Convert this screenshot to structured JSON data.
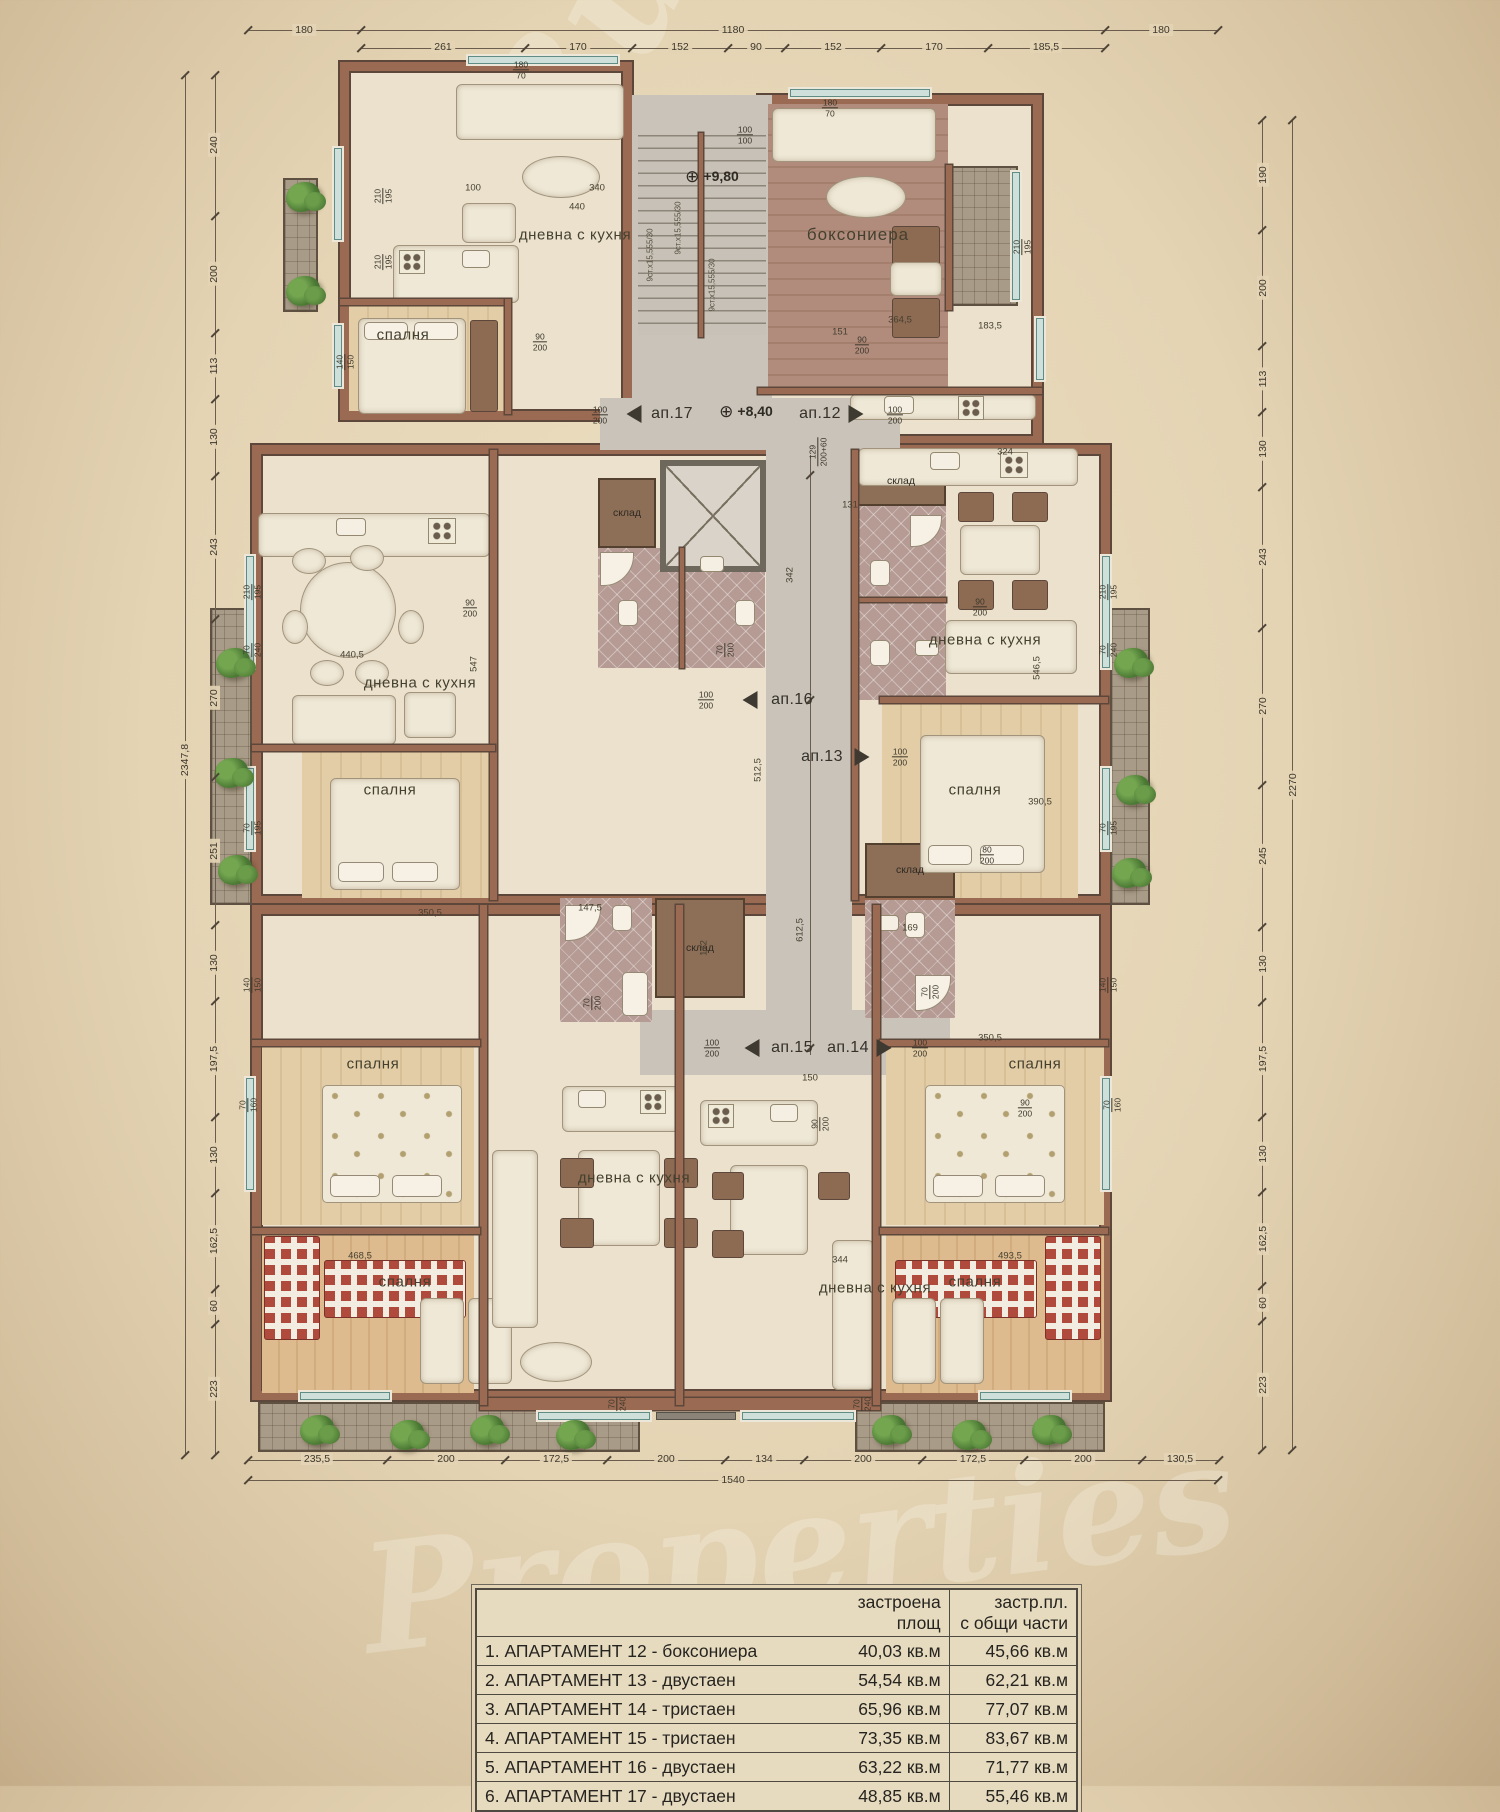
{
  "watermark": {
    "line1": "Bulgarian",
    "line2": "Properties"
  },
  "colors": {
    "wall": "#9b6a52",
    "wall_edge": "#5c473a",
    "floor": "#ebe1cc",
    "tile": "#b59b93",
    "corridor": "#c9c3b9",
    "window_glass": "#cfe0da",
    "paper": "#e4d4b4",
    "plant": "#4c7a35"
  },
  "plan": {
    "room_labels": [
      {
        "t": "дневна с кухня",
        "x": 575,
        "y": 235
      },
      {
        "t": "спалня",
        "x": 403,
        "y": 335
      },
      {
        "t": "боксониера",
        "x": 858,
        "y": 235,
        "big": 1
      },
      {
        "t": "дневна с кухня",
        "x": 420,
        "y": 683
      },
      {
        "t": "спалня",
        "x": 390,
        "y": 790
      },
      {
        "t": "дневна с кухня",
        "x": 985,
        "y": 640
      },
      {
        "t": "спалня",
        "x": 975,
        "y": 790
      },
      {
        "t": "спалня",
        "x": 373,
        "y": 1064
      },
      {
        "t": "дневна с кухня",
        "x": 634,
        "y": 1178
      },
      {
        "t": "спалня",
        "x": 405,
        "y": 1282
      },
      {
        "t": "дневна с кухня",
        "x": 875,
        "y": 1288
      },
      {
        "t": "спалня",
        "x": 1035,
        "y": 1064
      },
      {
        "t": "спалня",
        "x": 975,
        "y": 1282
      }
    ],
    "closet_labels": [
      {
        "t": "склад",
        "x": 627,
        "y": 513
      },
      {
        "t": "склад",
        "x": 901,
        "y": 481
      },
      {
        "t": "склад",
        "x": 700,
        "y": 948
      },
      {
        "t": "склад",
        "x": 910,
        "y": 870
      }
    ],
    "apt_markers": [
      {
        "t": "ап.17",
        "x": 672,
        "y": 414
      },
      {
        "t": "ап.12",
        "x": 820,
        "y": 414
      },
      {
        "t": "ап.16",
        "x": 792,
        "y": 700
      },
      {
        "t": "ап.13",
        "x": 822,
        "y": 757
      },
      {
        "t": "ап.15",
        "x": 792,
        "y": 1048
      },
      {
        "t": "ап.14",
        "x": 848,
        "y": 1048
      }
    ],
    "arrows": [
      {
        "d": "l",
        "x": 634,
        "y": 414
      },
      {
        "d": "r",
        "x": 856,
        "y": 414
      },
      {
        "d": "l",
        "x": 750,
        "y": 700
      },
      {
        "d": "r",
        "x": 862,
        "y": 757
      },
      {
        "d": "l",
        "x": 752,
        "y": 1048
      },
      {
        "d": "r",
        "x": 884,
        "y": 1048
      }
    ],
    "level_markers": [
      {
        "t": "+9,80",
        "x": 712,
        "y": 177
      },
      {
        "t": "+8,40",
        "x": 746,
        "y": 412
      }
    ],
    "opening_marks": [
      {
        "t": "210/195",
        "x": 383,
        "y": 196,
        "r": 1
      },
      {
        "t": "210/195",
        "x": 383,
        "y": 262,
        "r": 1
      },
      {
        "t": "140/150",
        "x": 345,
        "y": 362,
        "r": 1
      },
      {
        "t": "210/195",
        "x": 252,
        "y": 592,
        "r": 1
      },
      {
        "t": "70/240",
        "x": 252,
        "y": 650,
        "r": 1
      },
      {
        "t": "70/195",
        "x": 252,
        "y": 828,
        "r": 1
      },
      {
        "t": "140/150",
        "x": 252,
        "y": 985,
        "r": 1
      },
      {
        "t": "70/160",
        "x": 248,
        "y": 1105,
        "r": 1
      },
      {
        "t": "210/195",
        "x": 1108,
        "y": 592,
        "r": 1
      },
      {
        "t": "70/240",
        "x": 1108,
        "y": 650,
        "r": 1
      },
      {
        "t": "70/195",
        "x": 1108,
        "y": 828,
        "r": 1
      },
      {
        "t": "140/150",
        "x": 1108,
        "y": 985,
        "r": 1
      },
      {
        "t": "70/160",
        "x": 1112,
        "y": 1105,
        "r": 1
      },
      {
        "t": "180/70",
        "x": 521,
        "y": 70
      },
      {
        "t": "180/70",
        "x": 830,
        "y": 108
      },
      {
        "t": "100/100",
        "x": 745,
        "y": 135
      },
      {
        "t": "210/195",
        "x": 1022,
        "y": 247,
        "r": 1
      },
      {
        "t": "90/200",
        "x": 540,
        "y": 342
      },
      {
        "t": "90/200",
        "x": 862,
        "y": 345
      },
      {
        "t": "90/200",
        "x": 470,
        "y": 608
      },
      {
        "t": "90/200",
        "x": 980,
        "y": 607
      },
      {
        "t": "70/200",
        "x": 725,
        "y": 650,
        "r": 1
      },
      {
        "t": "70/200",
        "x": 592,
        "y": 1003,
        "r": 1
      },
      {
        "t": "70/200",
        "x": 930,
        "y": 992,
        "r": 1
      },
      {
        "t": "100/200",
        "x": 600,
        "y": 415
      },
      {
        "t": "100/200",
        "x": 895,
        "y": 415
      },
      {
        "t": "100/200",
        "x": 706,
        "y": 700
      },
      {
        "t": "100/200",
        "x": 900,
        "y": 757
      },
      {
        "t": "100/200",
        "x": 712,
        "y": 1048
      },
      {
        "t": "100/200",
        "x": 920,
        "y": 1048
      },
      {
        "t": "90/200",
        "x": 820,
        "y": 1124,
        "r": 1
      },
      {
        "t": "90/200",
        "x": 1025,
        "y": 1108
      },
      {
        "t": "70/240",
        "x": 617,
        "y": 1404,
        "r": 1
      },
      {
        "t": "70/240",
        "x": 862,
        "y": 1404,
        "r": 1
      },
      {
        "t": "80/200",
        "x": 987,
        "y": 855
      },
      {
        "t": "129/200+60",
        "x": 818,
        "y": 452,
        "r": 1
      }
    ],
    "inner_dims": [
      {
        "t": "100",
        "x": 473,
        "y": 188
      },
      {
        "t": "340",
        "x": 597,
        "y": 188
      },
      {
        "t": "440",
        "x": 577,
        "y": 207
      },
      {
        "t": "364,5",
        "x": 900,
        "y": 320
      },
      {
        "t": "183,5",
        "x": 990,
        "y": 326
      },
      {
        "t": "151",
        "x": 840,
        "y": 332
      },
      {
        "t": "324",
        "x": 1005,
        "y": 452
      },
      {
        "t": "440,5",
        "x": 352,
        "y": 655
      },
      {
        "t": "390,5",
        "x": 1040,
        "y": 802
      },
      {
        "t": "350,5",
        "x": 430,
        "y": 913
      },
      {
        "t": "350,5",
        "x": 990,
        "y": 1038
      },
      {
        "t": "468,5",
        "x": 360,
        "y": 1256
      },
      {
        "t": "493,5",
        "x": 1010,
        "y": 1256
      },
      {
        "t": "344",
        "x": 840,
        "y": 1260
      },
      {
        "t": "131",
        "x": 850,
        "y": 505
      },
      {
        "t": "150",
        "x": 810,
        "y": 1078
      },
      {
        "t": "147,5",
        "x": 590,
        "y": 908
      },
      {
        "t": "169",
        "x": 910,
        "y": 928
      },
      {
        "t": "342",
        "x": 790,
        "y": 575,
        "r": 1
      },
      {
        "t": "512,5",
        "x": 758,
        "y": 770,
        "r": 1
      },
      {
        "t": "612,5",
        "x": 800,
        "y": 930,
        "r": 1
      },
      {
        "t": "547",
        "x": 474,
        "y": 664,
        "r": 1
      },
      {
        "t": "546,5",
        "x": 1037,
        "y": 668,
        "r": 1
      },
      {
        "t": "172",
        "x": 704,
        "y": 948,
        "r": 1
      }
    ],
    "stair_notes": [
      {
        "t": "9ст.х15,555/30",
        "x": 650,
        "y": 255
      },
      {
        "t": "9ст.х15,555/30",
        "x": 678,
        "y": 228
      },
      {
        "t": "9ст.х15,555/30",
        "x": 712,
        "y": 285
      }
    ],
    "dim_labels": [
      {
        "t": "180",
        "x": 304,
        "y": 30
      },
      {
        "t": "1180",
        "x": 733,
        "y": 30
      },
      {
        "t": "180",
        "x": 1161,
        "y": 30
      },
      {
        "t": "261",
        "x": 443,
        "y": 47
      },
      {
        "t": "170",
        "x": 578,
        "y": 47
      },
      {
        "t": "152",
        "x": 680,
        "y": 47
      },
      {
        "t": "90",
        "x": 756,
        "y": 47
      },
      {
        "t": "152",
        "x": 833,
        "y": 47
      },
      {
        "t": "170",
        "x": 934,
        "y": 47
      },
      {
        "t": "185,5",
        "x": 1046,
        "y": 47
      },
      {
        "t": "235,5",
        "x": 317,
        "y": 1459
      },
      {
        "t": "200",
        "x": 446,
        "y": 1459
      },
      {
        "t": "172,5",
        "x": 556,
        "y": 1459
      },
      {
        "t": "200",
        "x": 666,
        "y": 1459
      },
      {
        "t": "134",
        "x": 764,
        "y": 1459
      },
      {
        "t": "200",
        "x": 863,
        "y": 1459
      },
      {
        "t": "172,5",
        "x": 973,
        "y": 1459
      },
      {
        "t": "200",
        "x": 1083,
        "y": 1459
      },
      {
        "t": "130,5",
        "x": 1180,
        "y": 1459
      },
      {
        "t": "1540",
        "x": 733,
        "y": 1480
      },
      {
        "t": "2347,8",
        "x": 185,
        "y": 760,
        "r": 1
      },
      {
        "t": "240",
        "x": 214,
        "y": 145,
        "r": 1
      },
      {
        "t": "200",
        "x": 214,
        "y": 274,
        "r": 1
      },
      {
        "t": "113",
        "x": 214,
        "y": 366,
        "r": 1
      },
      {
        "t": "130",
        "x": 214,
        "y": 437,
        "r": 1
      },
      {
        "t": "243",
        "x": 214,
        "y": 547,
        "r": 1
      },
      {
        "t": "270",
        "x": 214,
        "y": 698,
        "r": 1
      },
      {
        "t": "251",
        "x": 214,
        "y": 851,
        "r": 1
      },
      {
        "t": "130",
        "x": 214,
        "y": 963,
        "r": 1
      },
      {
        "t": "197,5",
        "x": 214,
        "y": 1059,
        "r": 1
      },
      {
        "t": "130",
        "x": 214,
        "y": 1155,
        "r": 1
      },
      {
        "t": "162,5",
        "x": 214,
        "y": 1241,
        "r": 1
      },
      {
        "t": "60",
        "x": 214,
        "y": 1306,
        "r": 1
      },
      {
        "t": "223",
        "x": 214,
        "y": 1389,
        "r": 1
      },
      {
        "t": "2270",
        "x": 1293,
        "y": 785,
        "r": 1
      },
      {
        "t": "190",
        "x": 1263,
        "y": 175,
        "r": 1
      },
      {
        "t": "200",
        "x": 1263,
        "y": 288,
        "r": 1
      },
      {
        "t": "113",
        "x": 1263,
        "y": 379,
        "r": 1
      },
      {
        "t": "130",
        "x": 1263,
        "y": 449,
        "r": 1
      },
      {
        "t": "243",
        "x": 1263,
        "y": 557,
        "r": 1
      },
      {
        "t": "270",
        "x": 1263,
        "y": 706,
        "r": 1
      },
      {
        "t": "245",
        "x": 1263,
        "y": 856,
        "r": 1
      },
      {
        "t": "130",
        "x": 1263,
        "y": 964,
        "r": 1
      },
      {
        "t": "197,5",
        "x": 1263,
        "y": 1059,
        "r": 1
      },
      {
        "t": "130",
        "x": 1263,
        "y": 1154,
        "r": 1
      },
      {
        "t": "162,5",
        "x": 1263,
        "y": 1239,
        "r": 1
      },
      {
        "t": "60",
        "x": 1263,
        "y": 1303,
        "r": 1
      },
      {
        "t": "223",
        "x": 1263,
        "y": 1385,
        "r": 1
      }
    ],
    "dim_lines": [
      {
        "x": 185,
        "y": 75,
        "w": 1,
        "h": 1380
      },
      {
        "x": 215,
        "y": 75,
        "w": 1,
        "h": 1380
      },
      {
        "x": 1262,
        "y": 120,
        "w": 1,
        "h": 1330
      },
      {
        "x": 1292,
        "y": 120,
        "w": 1,
        "h": 1330
      },
      {
        "x": 248,
        "y": 30,
        "w": 970,
        "h": 1
      },
      {
        "x": 361,
        "y": 48,
        "w": 744,
        "h": 1
      },
      {
        "x": 248,
        "y": 1460,
        "w": 971,
        "h": 1
      },
      {
        "x": 248,
        "y": 1480,
        "w": 970,
        "h": 1
      },
      {
        "x": 810,
        "y": 455,
        "w": 1,
        "h": 600
      }
    ],
    "dim_ticks": [
      {
        "y": 30,
        "xs": [
          248,
          361,
          1105,
          1218
        ]
      },
      {
        "y": 48,
        "xs": [
          361,
          525,
          632,
          728,
          785,
          881,
          988,
          1105
        ]
      },
      {
        "y": 1460,
        "xs": [
          248,
          387,
          505,
          607,
          725,
          804,
          922,
          1024,
          1142,
          1219
        ]
      },
      {
        "y": 1480,
        "xs": [
          248,
          1218
        ]
      },
      {
        "x": 185,
        "ys": [
          75,
          1455
        ]
      },
      {
        "x": 215,
        "ys": [
          75,
          216,
          333,
          399,
          476,
          619,
          777,
          925,
          1001,
          1117,
          1193,
          1289,
          1324,
          1455
        ]
      },
      {
        "x": 1262,
        "ys": [
          120,
          230,
          346,
          412,
          487,
          628,
          785,
          927,
          1002,
          1117,
          1192,
          1286,
          1321,
          1450
        ]
      },
      {
        "x": 1292,
        "ys": [
          120,
          1450
        ]
      },
      {
        "x": 810,
        "ys": [
          475,
          700,
          1048
        ]
      }
    ]
  },
  "legend_table": {
    "col2_header_l1": "застроена",
    "col2_header_l2": "площ",
    "col3_header_l1": "застр.пл.",
    "col3_header_l2": "с общи части",
    "rows": [
      {
        "name": "1. АПАРТАМЕНТ 12 - боксониера",
        "built_area": "40,03 кв.м",
        "total_area": "45,66 кв.м"
      },
      {
        "name": "2. АПАРТАМЕНТ 13 - двустаен",
        "built_area": "54,54 кв.м",
        "total_area": "62,21 кв.м"
      },
      {
        "name": "3. АПАРТАМЕНТ 14 - тристаен",
        "built_area": "65,96 кв.м",
        "total_area": "77,07 кв.м"
      },
      {
        "name": "4. АПАРТАМЕНТ 15 - тристаен",
        "built_area": "73,35 кв.м",
        "total_area": "83,67 кв.м"
      },
      {
        "name": "5. АПАРТАМЕНТ 16 - двустаен",
        "built_area": "63,22 кв.м",
        "total_area": "71,77 кв.м"
      },
      {
        "name": "6. АПАРТАМЕНТ 17 - двустаен",
        "built_area": "48,85 кв.м",
        "total_area": "55,46 кв.м"
      }
    ]
  }
}
